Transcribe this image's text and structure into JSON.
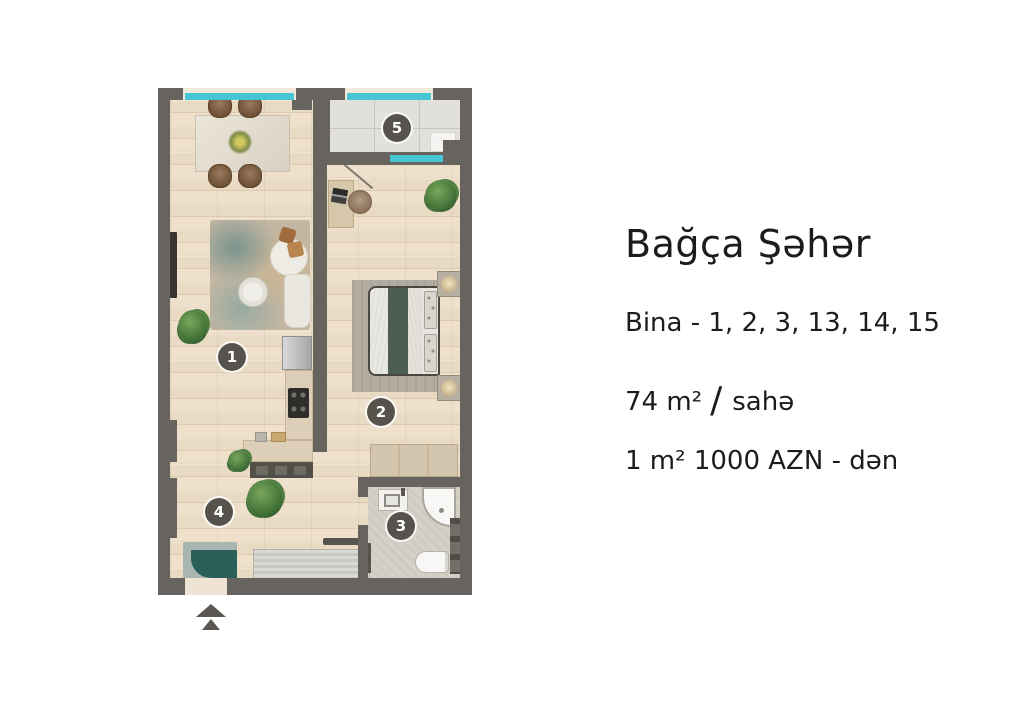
{
  "info": {
    "title": "Bağça Şəhər",
    "building_line": "Bina - 1, 2, 3, 13, 14, 15",
    "area_value": "74 m²",
    "area_separator": "/",
    "area_label": "sahə",
    "price_line": "1 m² 1000 AZN - dən"
  },
  "plan": {
    "markers": [
      {
        "number": "1"
      },
      {
        "number": "2"
      },
      {
        "number": "3"
      },
      {
        "number": "4"
      },
      {
        "number": "5"
      }
    ],
    "colors": {
      "wall": "#676460",
      "window": "#46c5d3",
      "wood_floor": "#e8dac3",
      "tile_floor": "#e2e0da",
      "bath_floor": "#d6d1c6",
      "marker_bg": "#56534d",
      "rug_teal": "#2a5f5a",
      "bed_green": "#4d5c50"
    },
    "icons": {
      "entrance_arrow": "double-up-arrow"
    }
  }
}
